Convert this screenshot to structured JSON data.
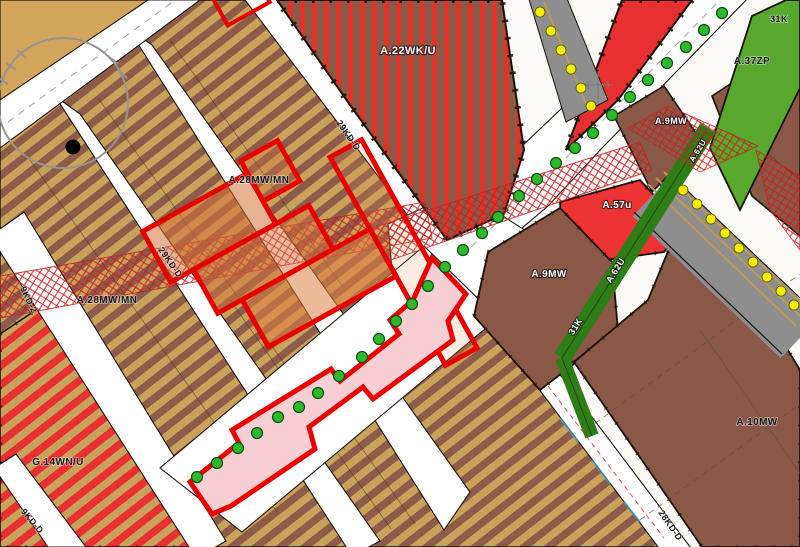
{
  "map": {
    "kind": "zoning-plan-map",
    "palette": {
      "road_white": "#ffffff",
      "tan_background": "#d2a55c",
      "stripe_light": "#c9a25b",
      "stripe_dark": "#8d5c49",
      "parcel_brown": "#8a5847",
      "red_zone": "#e93030",
      "red_stripe": "#e8302a",
      "green_area": "#57a82d",
      "green_strip": "#2f7d17",
      "rail_gray": "#8e8e8e",
      "rail_track_tan": "#c09a58",
      "dot_yellow": "#f5ee00",
      "tree_green": "#2eb82e",
      "corridor_pink_fill": "#f6ced4",
      "corridor_red_outline": "#ea0000",
      "hatch_red": "#c42222",
      "boundary_black": "#1a1208"
    },
    "labels": [
      {
        "id": "zone-a22wku",
        "text": "A.22WK/U",
        "x": 408,
        "y": 54,
        "rot": 0,
        "size": 11,
        "tone": "light"
      },
      {
        "id": "zone-a28-cluster",
        "text": "A.28MW/MN",
        "x": 259,
        "y": 183,
        "rot": 0,
        "size": 10,
        "tone": "dark"
      },
      {
        "id": "zone-a28-left",
        "text": "A.28MW/MN",
        "x": 107,
        "y": 303,
        "rot": 0,
        "size": 10,
        "tone": "dark"
      },
      {
        "id": "zone-g14wnu",
        "text": "G.14WN/U",
        "x": 58,
        "y": 465,
        "rot": 0,
        "size": 10,
        "tone": "dark"
      },
      {
        "id": "zone-a37zp",
        "text": "A.37ZP",
        "x": 752,
        "y": 64,
        "rot": 0,
        "size": 10,
        "tone": "dark"
      },
      {
        "id": "code-31k-corner",
        "text": "31K",
        "x": 779,
        "y": 22,
        "rot": 0,
        "size": 9,
        "tone": "dark"
      },
      {
        "id": "zone-a9mw-upper",
        "text": "A.9MW",
        "x": 671,
        "y": 124,
        "rot": 0,
        "size": 9,
        "tone": "light"
      },
      {
        "id": "strip-a62u-upper",
        "text": "A.62U",
        "x": 700,
        "y": 152,
        "rot": -58,
        "size": 8,
        "tone": "light"
      },
      {
        "id": "zone-a57u",
        "text": "A.57u",
        "x": 617,
        "y": 208,
        "rot": 0,
        "size": 10,
        "tone": "light"
      },
      {
        "id": "zone-a9mw-mid",
        "text": "A.9MW",
        "x": 549,
        "y": 277,
        "rot": 0,
        "size": 10,
        "tone": "light"
      },
      {
        "id": "strip-a62u-lower",
        "text": "A.62U",
        "x": 618,
        "y": 272,
        "rot": -58,
        "size": 9,
        "tone": "light"
      },
      {
        "id": "code-31k-strip",
        "text": "31K",
        "x": 578,
        "y": 328,
        "rot": -58,
        "size": 9,
        "tone": "light"
      },
      {
        "id": "zone-a10mw",
        "text": "A.10MW",
        "x": 757,
        "y": 425,
        "rot": 0,
        "size": 10,
        "tone": "dark"
      },
      {
        "id": "road-29kdd-top",
        "text": "29KD-D",
        "x": 346,
        "y": 137,
        "rot": 55,
        "size": 9,
        "tone": "dark"
      },
      {
        "id": "road-29kdd-left",
        "text": "29KD-D",
        "x": 168,
        "y": 264,
        "rot": 55,
        "size": 9,
        "tone": "dark"
      },
      {
        "id": "road-9kd2",
        "text": "9KD-2",
        "x": 26,
        "y": 301,
        "rot": 64,
        "size": 9,
        "tone": "dark"
      },
      {
        "id": "road-9kdd",
        "text": "9KD-D",
        "x": 30,
        "y": 523,
        "rot": 50,
        "size": 9,
        "tone": "dark"
      },
      {
        "id": "road-28kdd",
        "text": "28KD-D",
        "x": 668,
        "y": 527,
        "rot": 55,
        "size": 9,
        "tone": "dark"
      }
    ],
    "trees_green": [
      [
        722,
        13
      ],
      [
        704,
        30
      ],
      [
        686,
        47
      ],
      [
        667,
        63
      ],
      [
        648,
        80
      ],
      [
        630,
        97
      ],
      [
        612,
        115
      ],
      [
        593,
        133
      ],
      [
        575,
        148
      ],
      [
        556,
        163
      ],
      [
        537,
        179
      ],
      [
        519,
        196
      ],
      [
        498,
        217
      ],
      [
        482,
        233
      ],
      [
        463,
        250
      ],
      [
        445,
        267
      ],
      [
        428,
        286
      ],
      [
        412,
        304
      ],
      [
        396,
        321
      ],
      [
        379,
        339
      ],
      [
        362,
        357
      ],
      [
        339,
        376
      ],
      [
        318,
        393
      ],
      [
        299,
        407
      ],
      [
        278,
        417
      ],
      [
        257,
        433
      ],
      [
        238,
        448
      ],
      [
        217,
        463
      ],
      [
        197,
        477
      ]
    ],
    "dots_yellow": [
      [
        540,
        12
      ],
      [
        551,
        31
      ],
      [
        561,
        50
      ],
      [
        571,
        69
      ],
      [
        581,
        88
      ],
      [
        591,
        106
      ],
      [
        683,
        190
      ],
      [
        697,
        204
      ],
      [
        711,
        219
      ],
      [
        725,
        233
      ],
      [
        739,
        248
      ],
      [
        753,
        262
      ],
      [
        767,
        277
      ],
      [
        781,
        291
      ],
      [
        794,
        305
      ]
    ]
  }
}
